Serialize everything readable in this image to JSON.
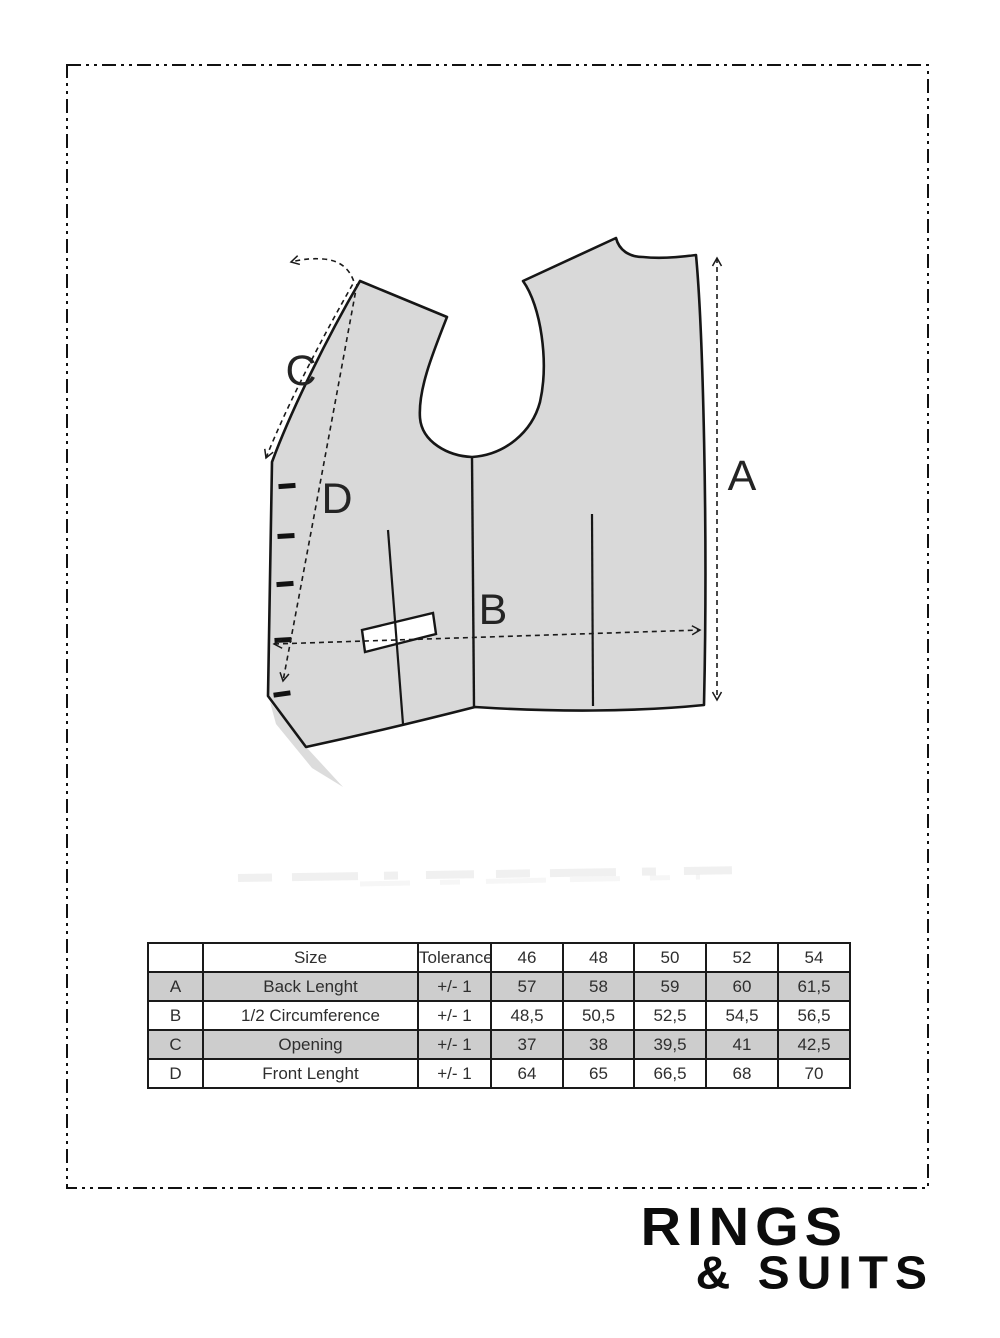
{
  "diagram": {
    "labels": {
      "a": "A",
      "b": "B",
      "c": "C",
      "d": "D"
    },
    "button_count": 5
  },
  "colors": {
    "ink": "#1a1a1a",
    "vest_fill": "#d9d9d9",
    "vest_shadow": "#d6d6d6",
    "row_shade": "#cdcdcd",
    "table_text": "#2e2e2e",
    "logo_black": "#0c0c0c"
  },
  "table": {
    "header": {
      "size": "Size",
      "tolerance": "Tolerance",
      "sizes": [
        "46",
        "48",
        "50",
        "52",
        "54"
      ]
    },
    "rows": [
      {
        "letter": "A",
        "label": "Back Lenght",
        "tolerance": "+/- 1",
        "values": [
          "57",
          "58",
          "59",
          "60",
          "61,5"
        ]
      },
      {
        "letter": "B",
        "label": "1/2 Circumference",
        "tolerance": "+/- 1",
        "values": [
          "48,5",
          "50,5",
          "52,5",
          "54,5",
          "56,5"
        ]
      },
      {
        "letter": "C",
        "label": "Opening",
        "tolerance": "+/- 1",
        "values": [
          "37",
          "38",
          "39,5",
          "41",
          "42,5"
        ]
      },
      {
        "letter": "D",
        "label": "Front Lenght",
        "tolerance": "+/- 1",
        "values": [
          "64",
          "65",
          "66,5",
          "68",
          "70"
        ]
      }
    ]
  },
  "logo": {
    "line1": "RINGS",
    "line2": "& SUITS"
  }
}
